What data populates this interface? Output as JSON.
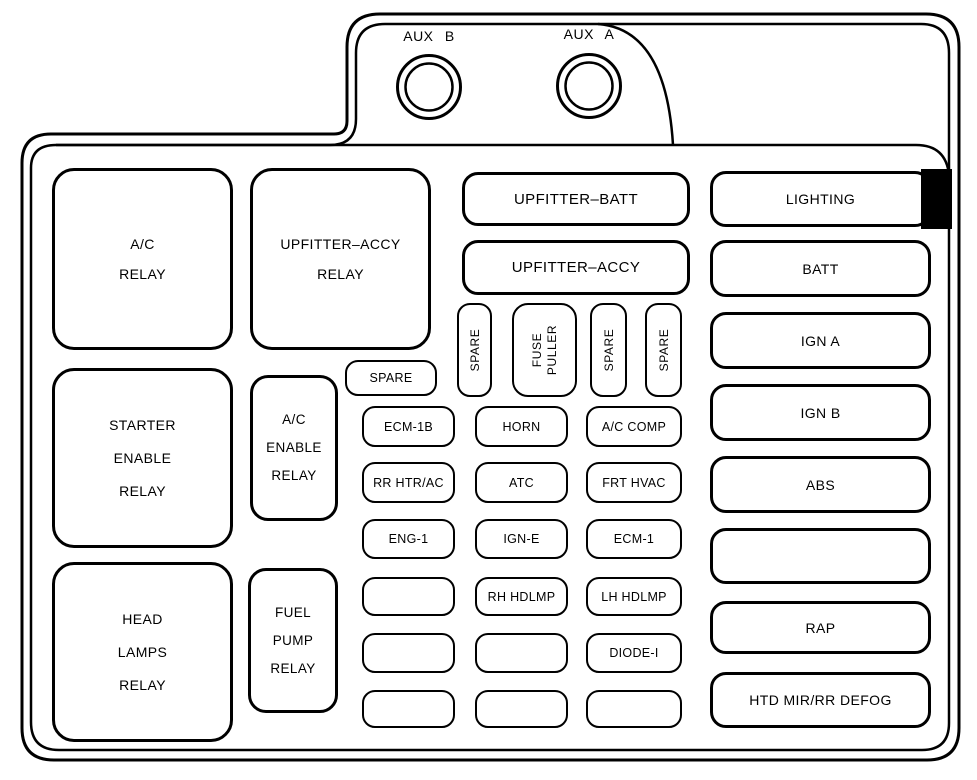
{
  "aux_terminals": {
    "b": "AUX B",
    "a": "AUX A"
  },
  "relays": {
    "ac": {
      "lines": [
        "A/C",
        "RELAY"
      ]
    },
    "upfitter_accy": {
      "lines": [
        "UPFITTER–ACCY",
        "RELAY"
      ]
    },
    "starter_enable": {
      "lines": [
        "STARTER",
        "ENABLE",
        "RELAY"
      ]
    },
    "ac_enable": {
      "lines": [
        "A/C",
        "ENABLE",
        "RELAY"
      ]
    },
    "head_lamps": {
      "lines": [
        "HEAD",
        "LAMPS",
        "RELAY"
      ]
    },
    "fuel_pump": {
      "lines": [
        "FUEL",
        "PUMP",
        "RELAY"
      ]
    }
  },
  "maxi_fuses": {
    "upfitter_batt": "UPFITTER–BATT",
    "upfitter_accy": "UPFITTER–ACCY"
  },
  "spare_fuse": "SPARE",
  "vertical_fuses": {
    "spare_1": "SPARE",
    "fuse_puller": {
      "lines": [
        "FUSE",
        "PULLER"
      ]
    },
    "spare_2": "SPARE",
    "spare_3": "SPARE"
  },
  "grid_fuses": [
    [
      "ECM-1B",
      "HORN",
      "A/C COMP"
    ],
    [
      "RR HTR/AC",
      "ATC",
      "FRT HVAC"
    ],
    [
      "ENG-1",
      "IGN-E",
      "ECM-1"
    ],
    [
      "",
      "RH HDLMP",
      "LH HDLMP"
    ],
    [
      "",
      "",
      "DIODE-I"
    ],
    [
      "",
      "",
      ""
    ]
  ],
  "right_fuses": [
    "LIGHTING",
    "BATT",
    "IGN A",
    "IGN B",
    "ABS",
    "",
    "RAP",
    "HTD MIR/RR DEFOG"
  ],
  "colors": {
    "line": "#000000",
    "background": "#ffffff",
    "connector_fill": "#000000"
  }
}
